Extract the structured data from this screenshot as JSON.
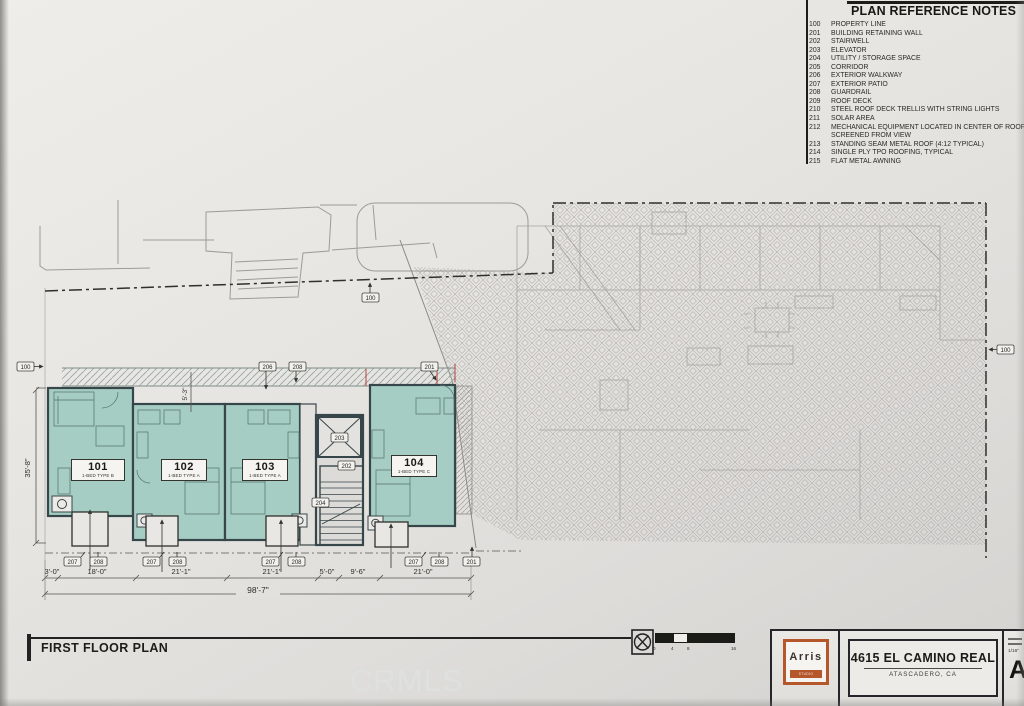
{
  "watermark": "CRMLS",
  "colors": {
    "paper": "#e6e4e0",
    "unit_fill": "#a6cdc3",
    "accent_orange": "#b5562b",
    "wall": "#37464a",
    "hatch_line": "#b3b1ad"
  },
  "notes": {
    "title": "PLAN REFERENCE NOTES",
    "items": [
      {
        "num": "100",
        "text": "PROPERTY LINE"
      },
      {
        "num": "201",
        "text": "BUILDING RETAINING WALL"
      },
      {
        "num": "202",
        "text": "STAIRWELL"
      },
      {
        "num": "203",
        "text": "ELEVATOR"
      },
      {
        "num": "204",
        "text": "UTILITY / STORAGE SPACE"
      },
      {
        "num": "205",
        "text": "CORRIDOR"
      },
      {
        "num": "206",
        "text": "EXTERIOR WALKWAY"
      },
      {
        "num": "207",
        "text": "EXTERIOR PATIO"
      },
      {
        "num": "208",
        "text": "GUARDRAIL"
      },
      {
        "num": "209",
        "text": "ROOF DECK"
      },
      {
        "num": "210",
        "text": "STEEL ROOF DECK TRELLIS WITH STRING LIGHTS"
      },
      {
        "num": "211",
        "text": "SOLAR AREA"
      },
      {
        "num": "212",
        "text": "MECHANICAL EQUIPMENT LOCATED IN CENTER OF ROOF"
      },
      {
        "num": "",
        "text": "SCREENED FROM VIEW"
      },
      {
        "num": "213",
        "text": "STANDING SEAM METAL ROOF (4:12 TYPICAL)"
      },
      {
        "num": "214",
        "text": "SINGLE PLY TPO ROOFING, TYPICAL"
      },
      {
        "num": "215",
        "text": "FLAT METAL AWNING"
      }
    ]
  },
  "plan": {
    "units": [
      {
        "number": "101",
        "type": "1-BED TYPE B"
      },
      {
        "number": "102",
        "type": "1-BED TYPE A"
      },
      {
        "number": "103",
        "type": "1-BED TYPE A"
      },
      {
        "number": "104",
        "type": "1-BED TYPE C"
      }
    ],
    "callouts": {
      "property_line": "100",
      "retaining_wall": "201",
      "stairwell": "202",
      "elevator": "203",
      "utility": "204",
      "corridor": "205",
      "walkway": "206",
      "patio": "207",
      "guardrail": "208"
    },
    "dims": {
      "bottom": [
        "3'-0\"",
        "18'-0\"",
        "21'-1\"",
        "21'-1\"",
        "5'-0\"",
        "9'-6\"",
        "21'-0\""
      ],
      "overall": "98'-7\"",
      "building_depth": "35'-8\"",
      "walkway_width": "5'-3\""
    }
  },
  "scale_bar": {
    "ticks": [
      "0",
      "4",
      "8",
      "16"
    ]
  },
  "footer": {
    "view_title": "FIRST FLOOR PLAN"
  },
  "title_block": {
    "logo_text": "Arris",
    "logo_subtext": "STUDIO ARCHITECTS",
    "project_title": "4615 EL CAMINO REAL",
    "project_subtitle": "ATASCADERO, CA",
    "scale_note": "1/16\"",
    "sheet_prefix": "A"
  }
}
